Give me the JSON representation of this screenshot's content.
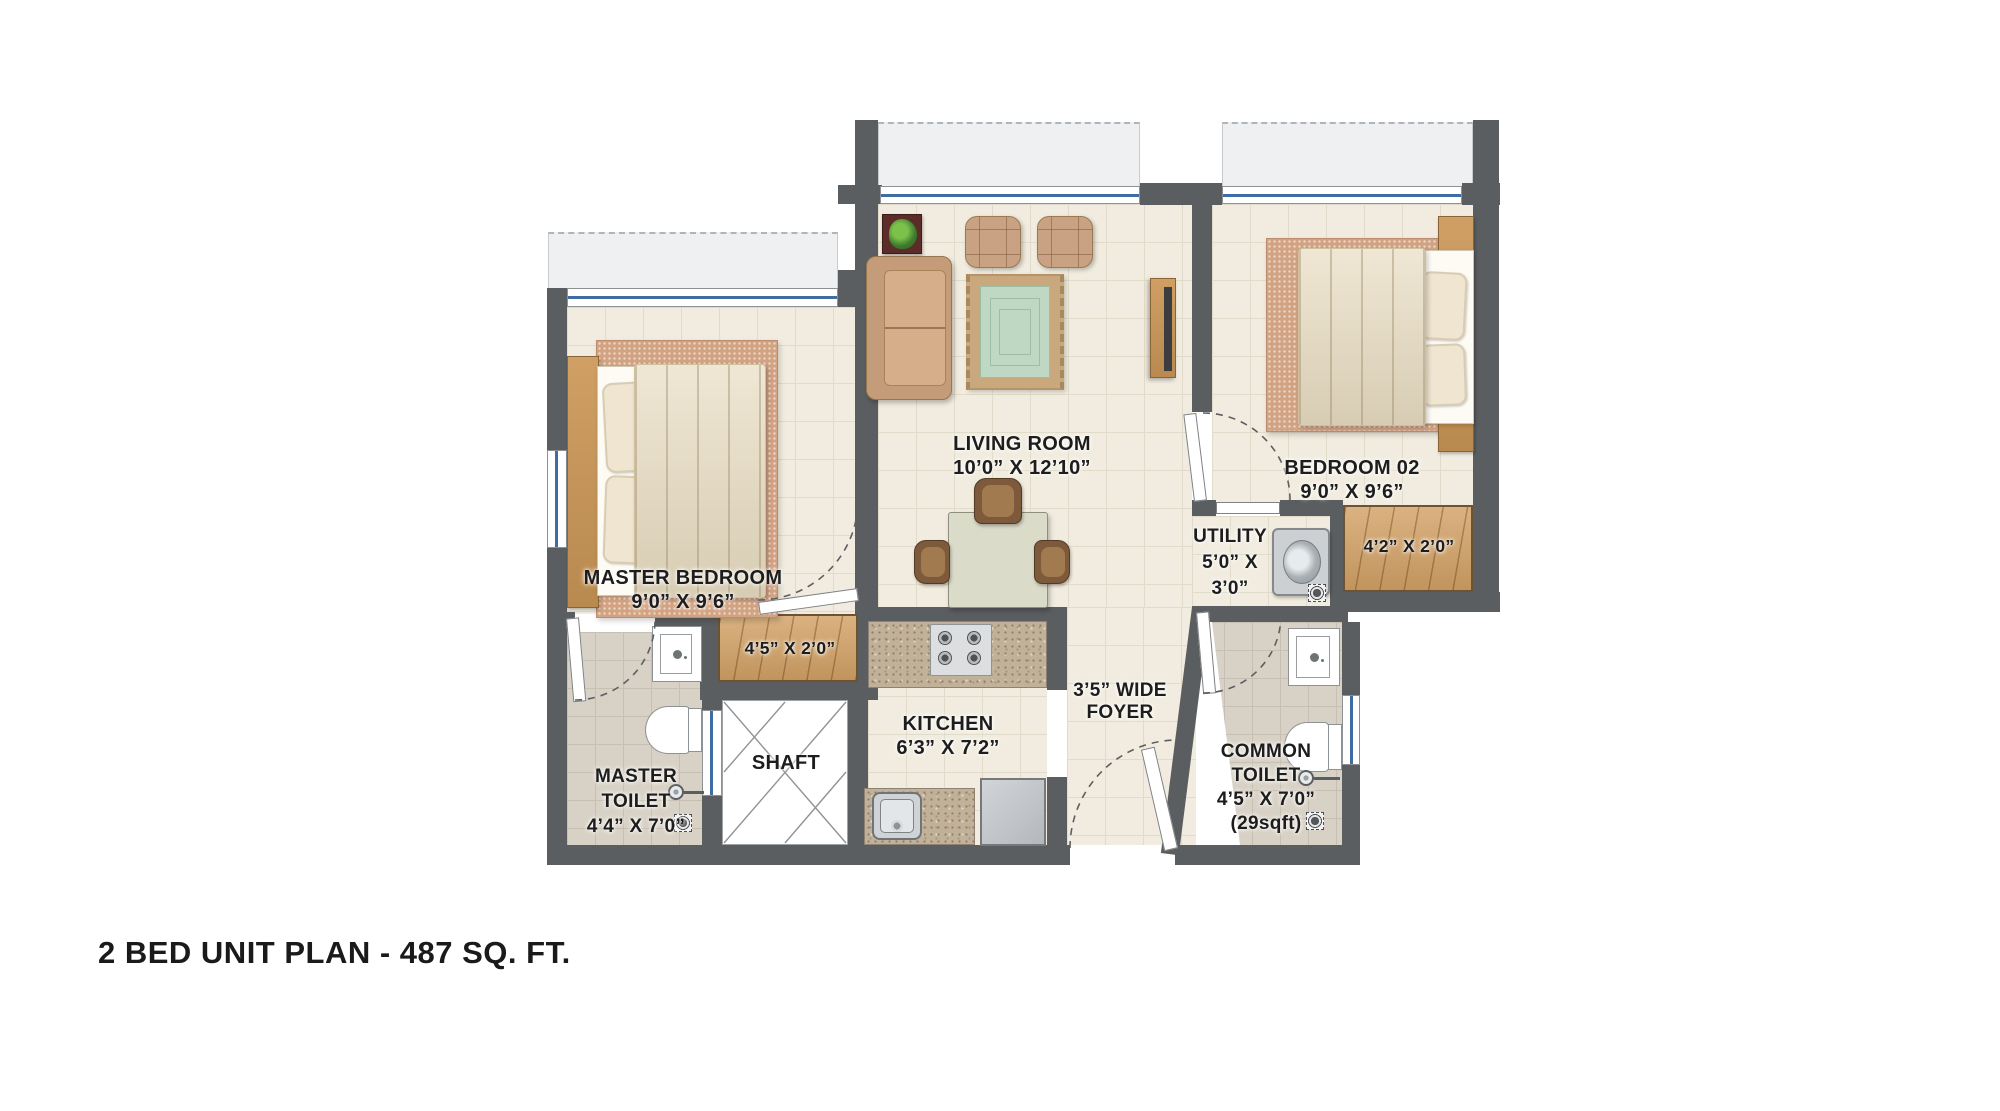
{
  "title": "2 BED UNIT PLAN - 487 SQ. FT.",
  "rooms": {
    "living_room": {
      "name": "LIVING ROOM",
      "dims": "10’0” X 12’10”"
    },
    "master_bedroom": {
      "name": "MASTER BEDROOM",
      "dims": "9’0” X 9’6”"
    },
    "bedroom_02": {
      "name": "BEDROOM 02",
      "dims": "9’0” X 9’6”"
    },
    "kitchen": {
      "name": "KITCHEN",
      "dims": "6’3” X 7’2”"
    },
    "utility": {
      "name": "UTILITY",
      "dims_line1": "5’0” X",
      "dims_line2": "3’0”"
    },
    "foyer": {
      "line1": "3’5” WIDE",
      "line2": "FOYER"
    },
    "master_toilet": {
      "line1": "MASTER",
      "line2": "TOILET",
      "dims": "4’4” X 7’0”"
    },
    "common_toilet": {
      "line1": "COMMON",
      "line2": "TOILET",
      "dims": "4’5” X 7’0”",
      "area": "(29sqft)"
    },
    "shaft": {
      "name": "SHAFT"
    }
  },
  "wardrobes": {
    "master_dims": "4’5” X 2’0”",
    "bedroom02_dims": "4’2” X 2’0”"
  },
  "colors": {
    "wall": "#5b5e60",
    "floor": "#f1ecdf",
    "tile": "#d8d1c5",
    "wood": "#d2a165",
    "granite": "#c2b199",
    "window_blue": "#3e6ca3",
    "balcony": "#eef0f2",
    "text": "#1d1d1d"
  }
}
